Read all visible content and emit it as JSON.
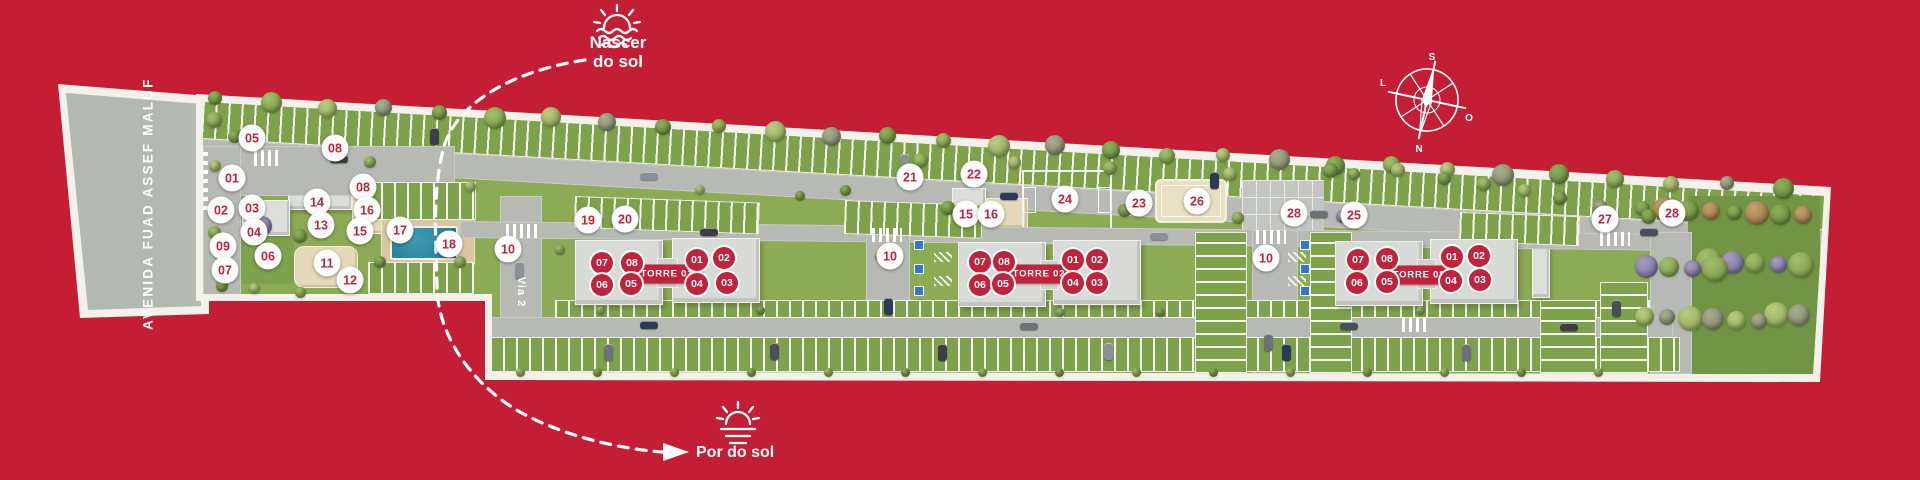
{
  "colors": {
    "background": "#c41e35",
    "marker_red": "#c0233c",
    "marker_white": "#ffffff",
    "grass": "#8cab55",
    "road": "#b7bab4"
  },
  "legend": {
    "sunrise": {
      "line1": "Nascer",
      "line2": "do sol"
    },
    "sunset": {
      "label": "Por do sol"
    }
  },
  "compass": {
    "top": "S",
    "right": "O",
    "bottom": "N",
    "left": "L"
  },
  "streets": {
    "avenue": "AVENIDA FUAD ASSEF MALUF",
    "internal": "Via 2"
  },
  "towers": [
    {
      "label": "TORRE 01",
      "label_x": 667,
      "label_y": 274,
      "units": [
        {
          "n": "07",
          "x": 602,
          "y": 263
        },
        {
          "n": "08",
          "x": 632,
          "y": 263
        },
        {
          "n": "01",
          "x": 697,
          "y": 260
        },
        {
          "n": "02",
          "x": 724,
          "y": 258
        },
        {
          "n": "06",
          "x": 602,
          "y": 285
        },
        {
          "n": "05",
          "x": 631,
          "y": 284
        },
        {
          "n": "04",
          "x": 697,
          "y": 284
        },
        {
          "n": "03",
          "x": 727,
          "y": 283
        }
      ]
    },
    {
      "label": "TORRE 02",
      "label_x": 1039,
      "label_y": 274,
      "units": [
        {
          "n": "07",
          "x": 980,
          "y": 262
        },
        {
          "n": "08",
          "x": 1004,
          "y": 262
        },
        {
          "n": "01",
          "x": 1073,
          "y": 260
        },
        {
          "n": "02",
          "x": 1097,
          "y": 260
        },
        {
          "n": "06",
          "x": 980,
          "y": 285
        },
        {
          "n": "05",
          "x": 1003,
          "y": 284
        },
        {
          "n": "04",
          "x": 1073,
          "y": 283
        },
        {
          "n": "03",
          "x": 1097,
          "y": 283
        }
      ]
    },
    {
      "label": "TORRE 03",
      "label_x": 1419,
      "label_y": 275,
      "units": [
        {
          "n": "07",
          "x": 1358,
          "y": 260
        },
        {
          "n": "08",
          "x": 1387,
          "y": 259
        },
        {
          "n": "01",
          "x": 1452,
          "y": 257
        },
        {
          "n": "02",
          "x": 1479,
          "y": 256
        },
        {
          "n": "06",
          "x": 1357,
          "y": 283
        },
        {
          "n": "05",
          "x": 1387,
          "y": 282
        },
        {
          "n": "04",
          "x": 1451,
          "y": 281
        },
        {
          "n": "03",
          "x": 1480,
          "y": 280
        }
      ]
    }
  ],
  "site_markers": [
    {
      "n": "05",
      "x": 252,
      "y": 138
    },
    {
      "n": "08",
      "x": 335,
      "y": 148
    },
    {
      "n": "01",
      "x": 232,
      "y": 178
    },
    {
      "n": "08",
      "x": 363,
      "y": 187
    },
    {
      "n": "02",
      "x": 221,
      "y": 210
    },
    {
      "n": "03",
      "x": 252,
      "y": 208
    },
    {
      "n": "14",
      "x": 317,
      "y": 202
    },
    {
      "n": "16",
      "x": 367,
      "y": 210
    },
    {
      "n": "04",
      "x": 254,
      "y": 232
    },
    {
      "n": "13",
      "x": 321,
      "y": 225
    },
    {
      "n": "15",
      "x": 360,
      "y": 231
    },
    {
      "n": "09",
      "x": 223,
      "y": 246
    },
    {
      "n": "06",
      "x": 268,
      "y": 256
    },
    {
      "n": "07",
      "x": 225,
      "y": 270
    },
    {
      "n": "11",
      "x": 327,
      "y": 263
    },
    {
      "n": "12",
      "x": 350,
      "y": 280
    },
    {
      "n": "17",
      "x": 400,
      "y": 230
    },
    {
      "n": "18",
      "x": 449,
      "y": 244
    },
    {
      "n": "10",
      "x": 508,
      "y": 249
    },
    {
      "n": "19",
      "x": 588,
      "y": 220
    },
    {
      "n": "20",
      "x": 625,
      "y": 219
    },
    {
      "n": "21",
      "x": 910,
      "y": 177
    },
    {
      "n": "22",
      "x": 974,
      "y": 174
    },
    {
      "n": "15",
      "x": 966,
      "y": 214
    },
    {
      "n": "16",
      "x": 991,
      "y": 214
    },
    {
      "n": "24",
      "x": 1065,
      "y": 199
    },
    {
      "n": "23",
      "x": 1139,
      "y": 203
    },
    {
      "n": "26",
      "x": 1197,
      "y": 201
    },
    {
      "n": "28",
      "x": 1294,
      "y": 213
    },
    {
      "n": "25",
      "x": 1354,
      "y": 215
    },
    {
      "n": "10",
      "x": 890,
      "y": 256
    },
    {
      "n": "10",
      "x": 1266,
      "y": 258
    },
    {
      "n": "27",
      "x": 1605,
      "y": 219
    },
    {
      "n": "28",
      "x": 1672,
      "y": 213
    }
  ]
}
